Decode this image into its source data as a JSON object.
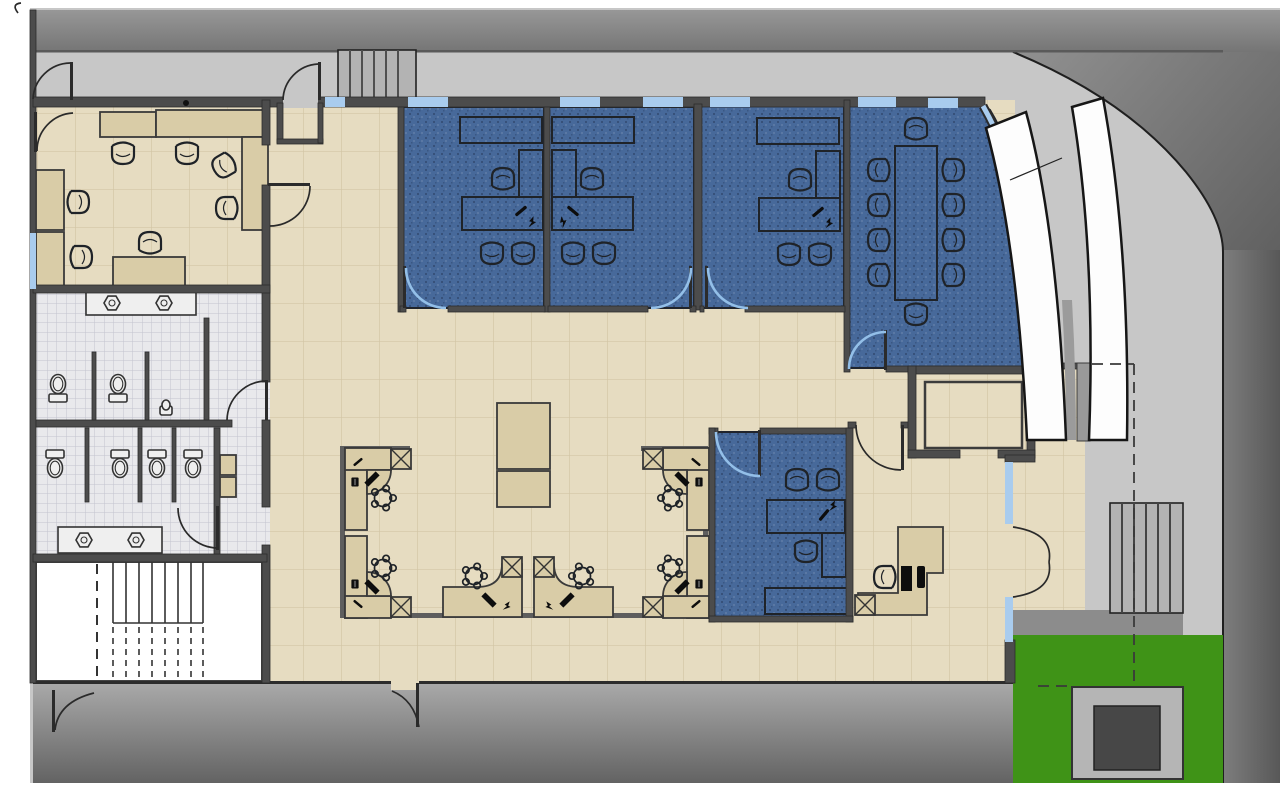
{
  "title": "office-suite-floor-plan",
  "palette": {
    "paper": "#ffffff",
    "sidewalk": "#c7c7c7",
    "wall": "#4c4c4c",
    "wall-dark": "#2c2c2c",
    "floor-tan": "#e6dcc1",
    "tile-line": "#d2c5a5",
    "counter": "#d9cca7",
    "furn": "#1f2328",
    "carpet": "#47699a",
    "bath": "#e9e9ec",
    "bath-line": "#c2c4ce",
    "fixture": "#efefef",
    "glass": "#a9ccee",
    "glass-arc": "#93bfe8",
    "grass": "#3f9317",
    "planter": "#b5b5b5",
    "planter-dark": "#474747",
    "steps": "#b3b3b3",
    "canopy": "#fdfdfd",
    "outline": "#161616",
    "partition": "#5e5e5e"
  },
  "plan": {
    "rooms": [
      {
        "name": "break-room",
        "floor": "tan-tile",
        "counters": 5,
        "tables": 1,
        "chairs": 7
      },
      {
        "name": "mens-restroom",
        "floor": "small-tile",
        "toilets": 2,
        "urinals": 1,
        "sinks": 2
      },
      {
        "name": "womens-restroom",
        "floor": "small-tile",
        "toilets": 4,
        "sinks": 2
      },
      {
        "name": "stairwell",
        "floor": "white",
        "stair_runs": 2
      },
      {
        "name": "private-office-1",
        "floor": "blue-carpet",
        "desks": 1,
        "credenzas": 1,
        "task_chairs": 1,
        "guest_chairs": 2
      },
      {
        "name": "private-office-2",
        "floor": "blue-carpet",
        "desks": 1,
        "credenzas": 1,
        "task_chairs": 1,
        "guest_chairs": 2
      },
      {
        "name": "private-office-3",
        "floor": "blue-carpet",
        "desks": 1,
        "credenzas": 1,
        "task_chairs": 1,
        "guest_chairs": 2
      },
      {
        "name": "conference-room",
        "floor": "blue-carpet",
        "tables": 1,
        "chairs": 10,
        "curved_glass_wall": true
      },
      {
        "name": "private-office-4",
        "floor": "blue-carpet",
        "desks": 1,
        "credenzas": 1,
        "task_chairs": 1,
        "guest_chairs": 2
      },
      {
        "name": "open-office",
        "floor": "tan-tile",
        "workstations": 6,
        "file_pedestals": 6,
        "layout_tables": 2
      },
      {
        "name": "reception",
        "floor": "tan-tile",
        "desks": 1,
        "task_chairs": 1,
        "monitors": 1
      },
      {
        "name": "storage-vestibule",
        "floor": "tan-tile"
      },
      {
        "name": "entry-alcove",
        "floor": "tan-tile",
        "double_door": true
      }
    ],
    "exterior": {
      "features": [
        "top-sidewalk",
        "entry-steps-top",
        "curved-corner",
        "white-canopy-bands",
        "side-steps",
        "lawn",
        "concrete-planter",
        "lower-walkway",
        "roof-overhang-dashed-lines"
      ],
      "entry_steps_top": 6,
      "side_steps": 6
    }
  }
}
